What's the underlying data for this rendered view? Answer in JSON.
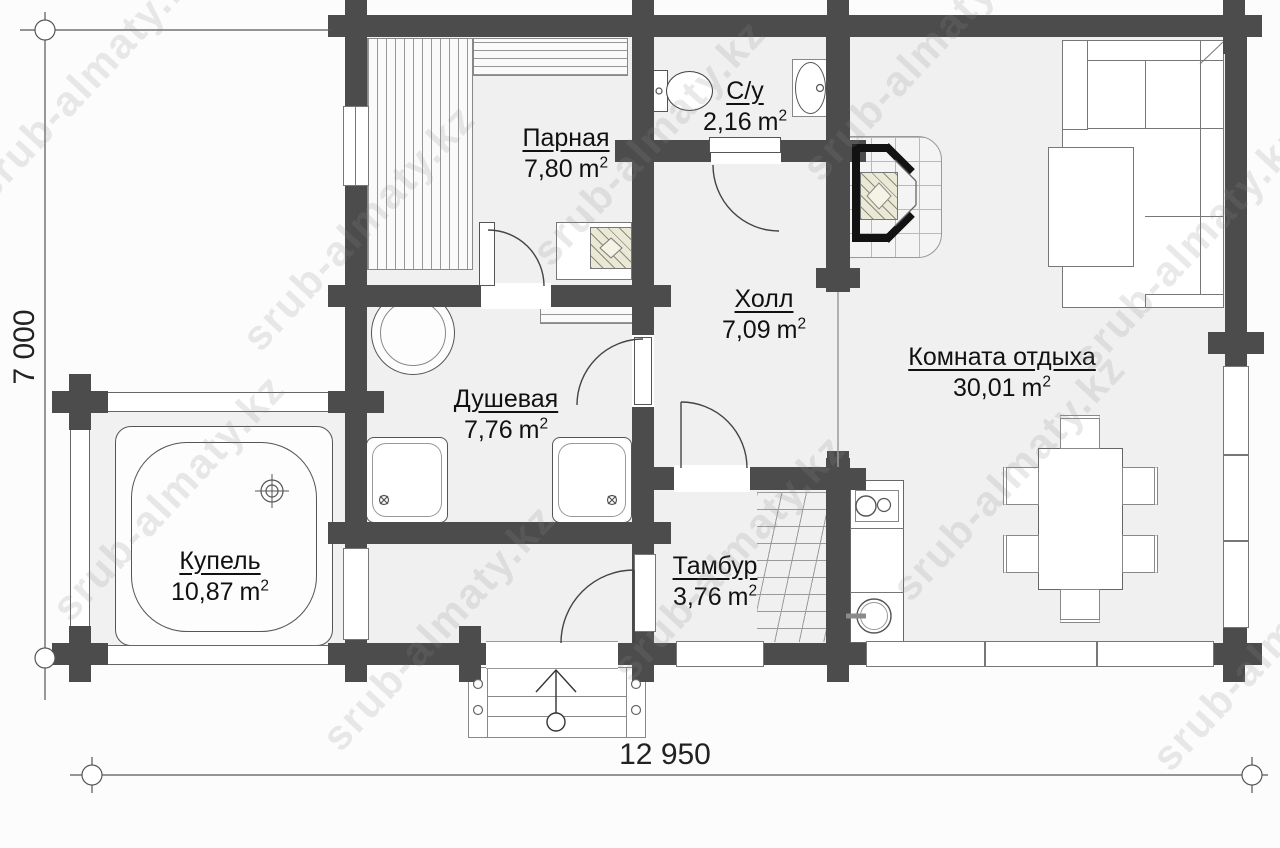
{
  "watermark": "srub-almaty.kz",
  "dimensions": {
    "width": "12 950",
    "height": "7 000"
  },
  "units": {
    "base": "m",
    "sup": "2"
  },
  "rooms": {
    "parnaya": {
      "name": "Парная",
      "area": "7,80"
    },
    "su": {
      "name": "С/у",
      "area": "2,16"
    },
    "holl": {
      "name": "Холл",
      "area": "7,09"
    },
    "komnata": {
      "name": "Комната отдыха",
      "area": "30,01"
    },
    "dushevaya": {
      "name": "Душевая",
      "area": "7,76"
    },
    "tambur": {
      "name": "Тамбур",
      "area": "3,76"
    },
    "kupel": {
      "name": "Купель",
      "area": "10,87"
    }
  },
  "colors": {
    "wall": "#4c4c4c",
    "floor": "#f0f0f0",
    "line": "#8c8c8c",
    "stove_fill": "#eae9d8",
    "watermark": "#8a8a8a"
  }
}
